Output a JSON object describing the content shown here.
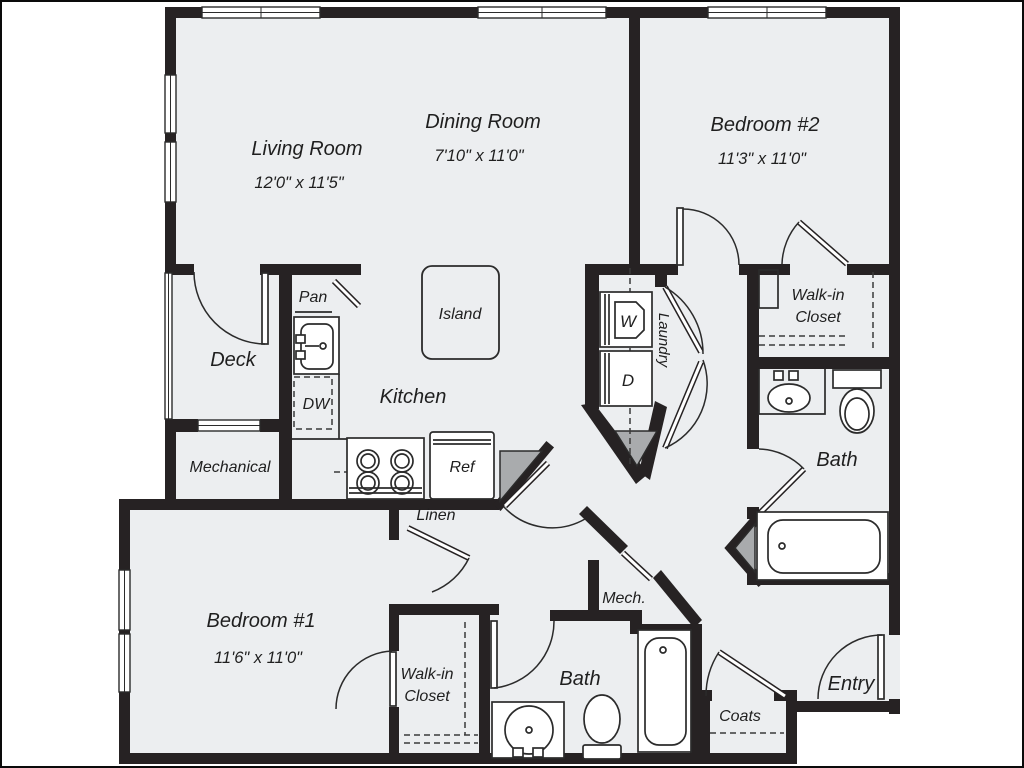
{
  "colors": {
    "wall": "#262223",
    "floor": "#eceef0",
    "wedge": "#a9abad",
    "line": "#2b2b2b",
    "text": "#1f1f1f",
    "background": "#ffffff"
  },
  "rooms": {
    "living": {
      "name": "Living Room",
      "dims": "12'0\" x 11'5\""
    },
    "dining": {
      "name": "Dining Room",
      "dims": "7'10\" x 11'0\""
    },
    "bedroom2": {
      "name": "Bedroom #2",
      "dims": "11'3\" x 11'0\""
    },
    "bedroom1": {
      "name": "Bedroom #1",
      "dims": "11'6\" x 11'0\""
    },
    "closet2": {
      "line1": "Walk-in",
      "line2": "Closet"
    },
    "closet1": {
      "line1": "Walk-in",
      "line2": "Closet"
    },
    "bath2": {
      "name": "Bath"
    },
    "bath1": {
      "name": "Bath"
    },
    "deck": {
      "name": "Deck"
    },
    "mechanical": {
      "name": "Mechanical"
    },
    "kitchen": {
      "name": "Kitchen"
    },
    "laundry": {
      "name": "Laundry"
    },
    "entry": {
      "name": "Entry"
    },
    "coats": {
      "name": "Coats"
    },
    "linen": {
      "name": "Linen"
    },
    "mech": {
      "name": "Mech."
    },
    "pantry": {
      "name": "Pan"
    },
    "island": {
      "name": "Island"
    }
  },
  "appliances": {
    "dishwasher": "DW",
    "refrigerator": "Ref",
    "washer": "W",
    "dryer": "D"
  }
}
